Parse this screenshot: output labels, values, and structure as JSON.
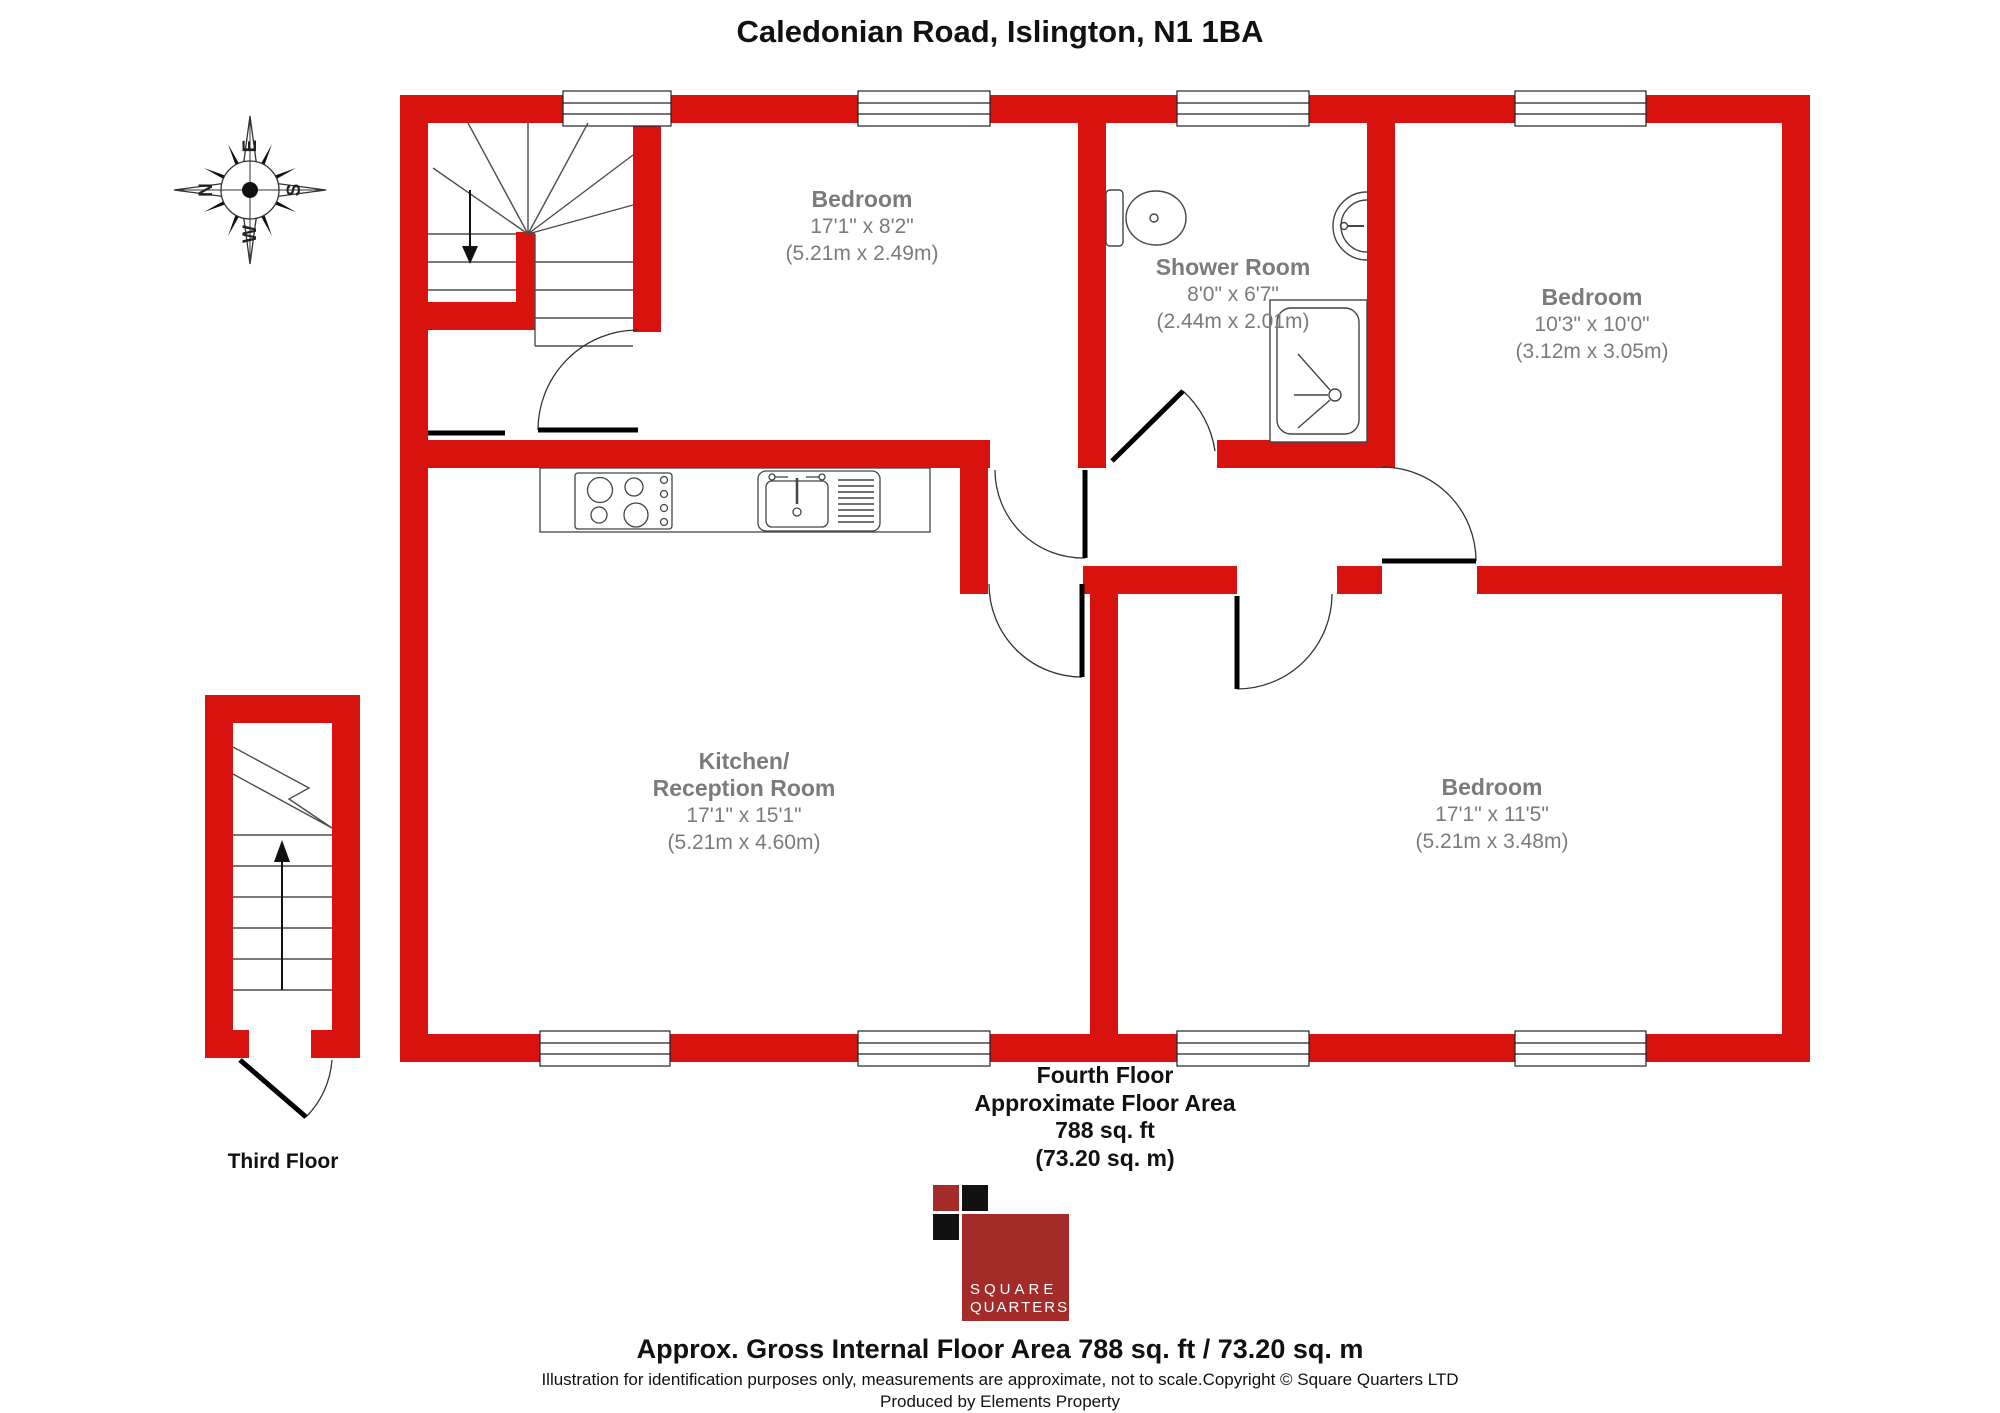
{
  "title": "Caledonian Road, Islington, N1 1BA",
  "compass": {
    "n": "N",
    "e": "E",
    "s": "S",
    "w": "W"
  },
  "rooms": [
    {
      "name": "Bedroom",
      "imperial": "17'1\" x 8'2\"",
      "metric": "(5.21m x 2.49m)"
    },
    {
      "name": "Shower Room",
      "imperial": "8'0\" x 6'7\"",
      "metric": "(2.44m x 2.01m)"
    },
    {
      "name": "Bedroom",
      "imperial": "10'3\" x 10'0\"",
      "metric": "(3.12m x 3.05m)"
    },
    {
      "name": "Kitchen/",
      "name2": "Reception Room",
      "imperial": "17'1\" x 15'1\"",
      "metric": "(5.21m x 4.60m)"
    },
    {
      "name": "Bedroom",
      "imperial": "17'1\" x 11'5\"",
      "metric": "(5.21m x 3.48m)"
    }
  ],
  "floor_summary": {
    "floor": "Fourth Floor",
    "area_label": "Approximate Floor Area",
    "area_ft": "788 sq. ft",
    "area_m": "(73.20 sq. m)"
  },
  "third_floor": "Third Floor",
  "logo": {
    "line1": "SQUARE",
    "line2": "QUARTERS"
  },
  "footer": {
    "line1": "Approx. Gross Internal Floor Area 788 sq. ft / 73.20 sq. m",
    "line2": "Illustration for identification purposes only, measurements are approximate, not to scale.Copyright © Square Quarters LTD",
    "line3": "Produced by Elements Property"
  },
  "colors": {
    "wall_red": "#D8130F",
    "label_gray": "#7B7B7B",
    "logo_red": "#A32C28",
    "logo_black": "#111111"
  }
}
